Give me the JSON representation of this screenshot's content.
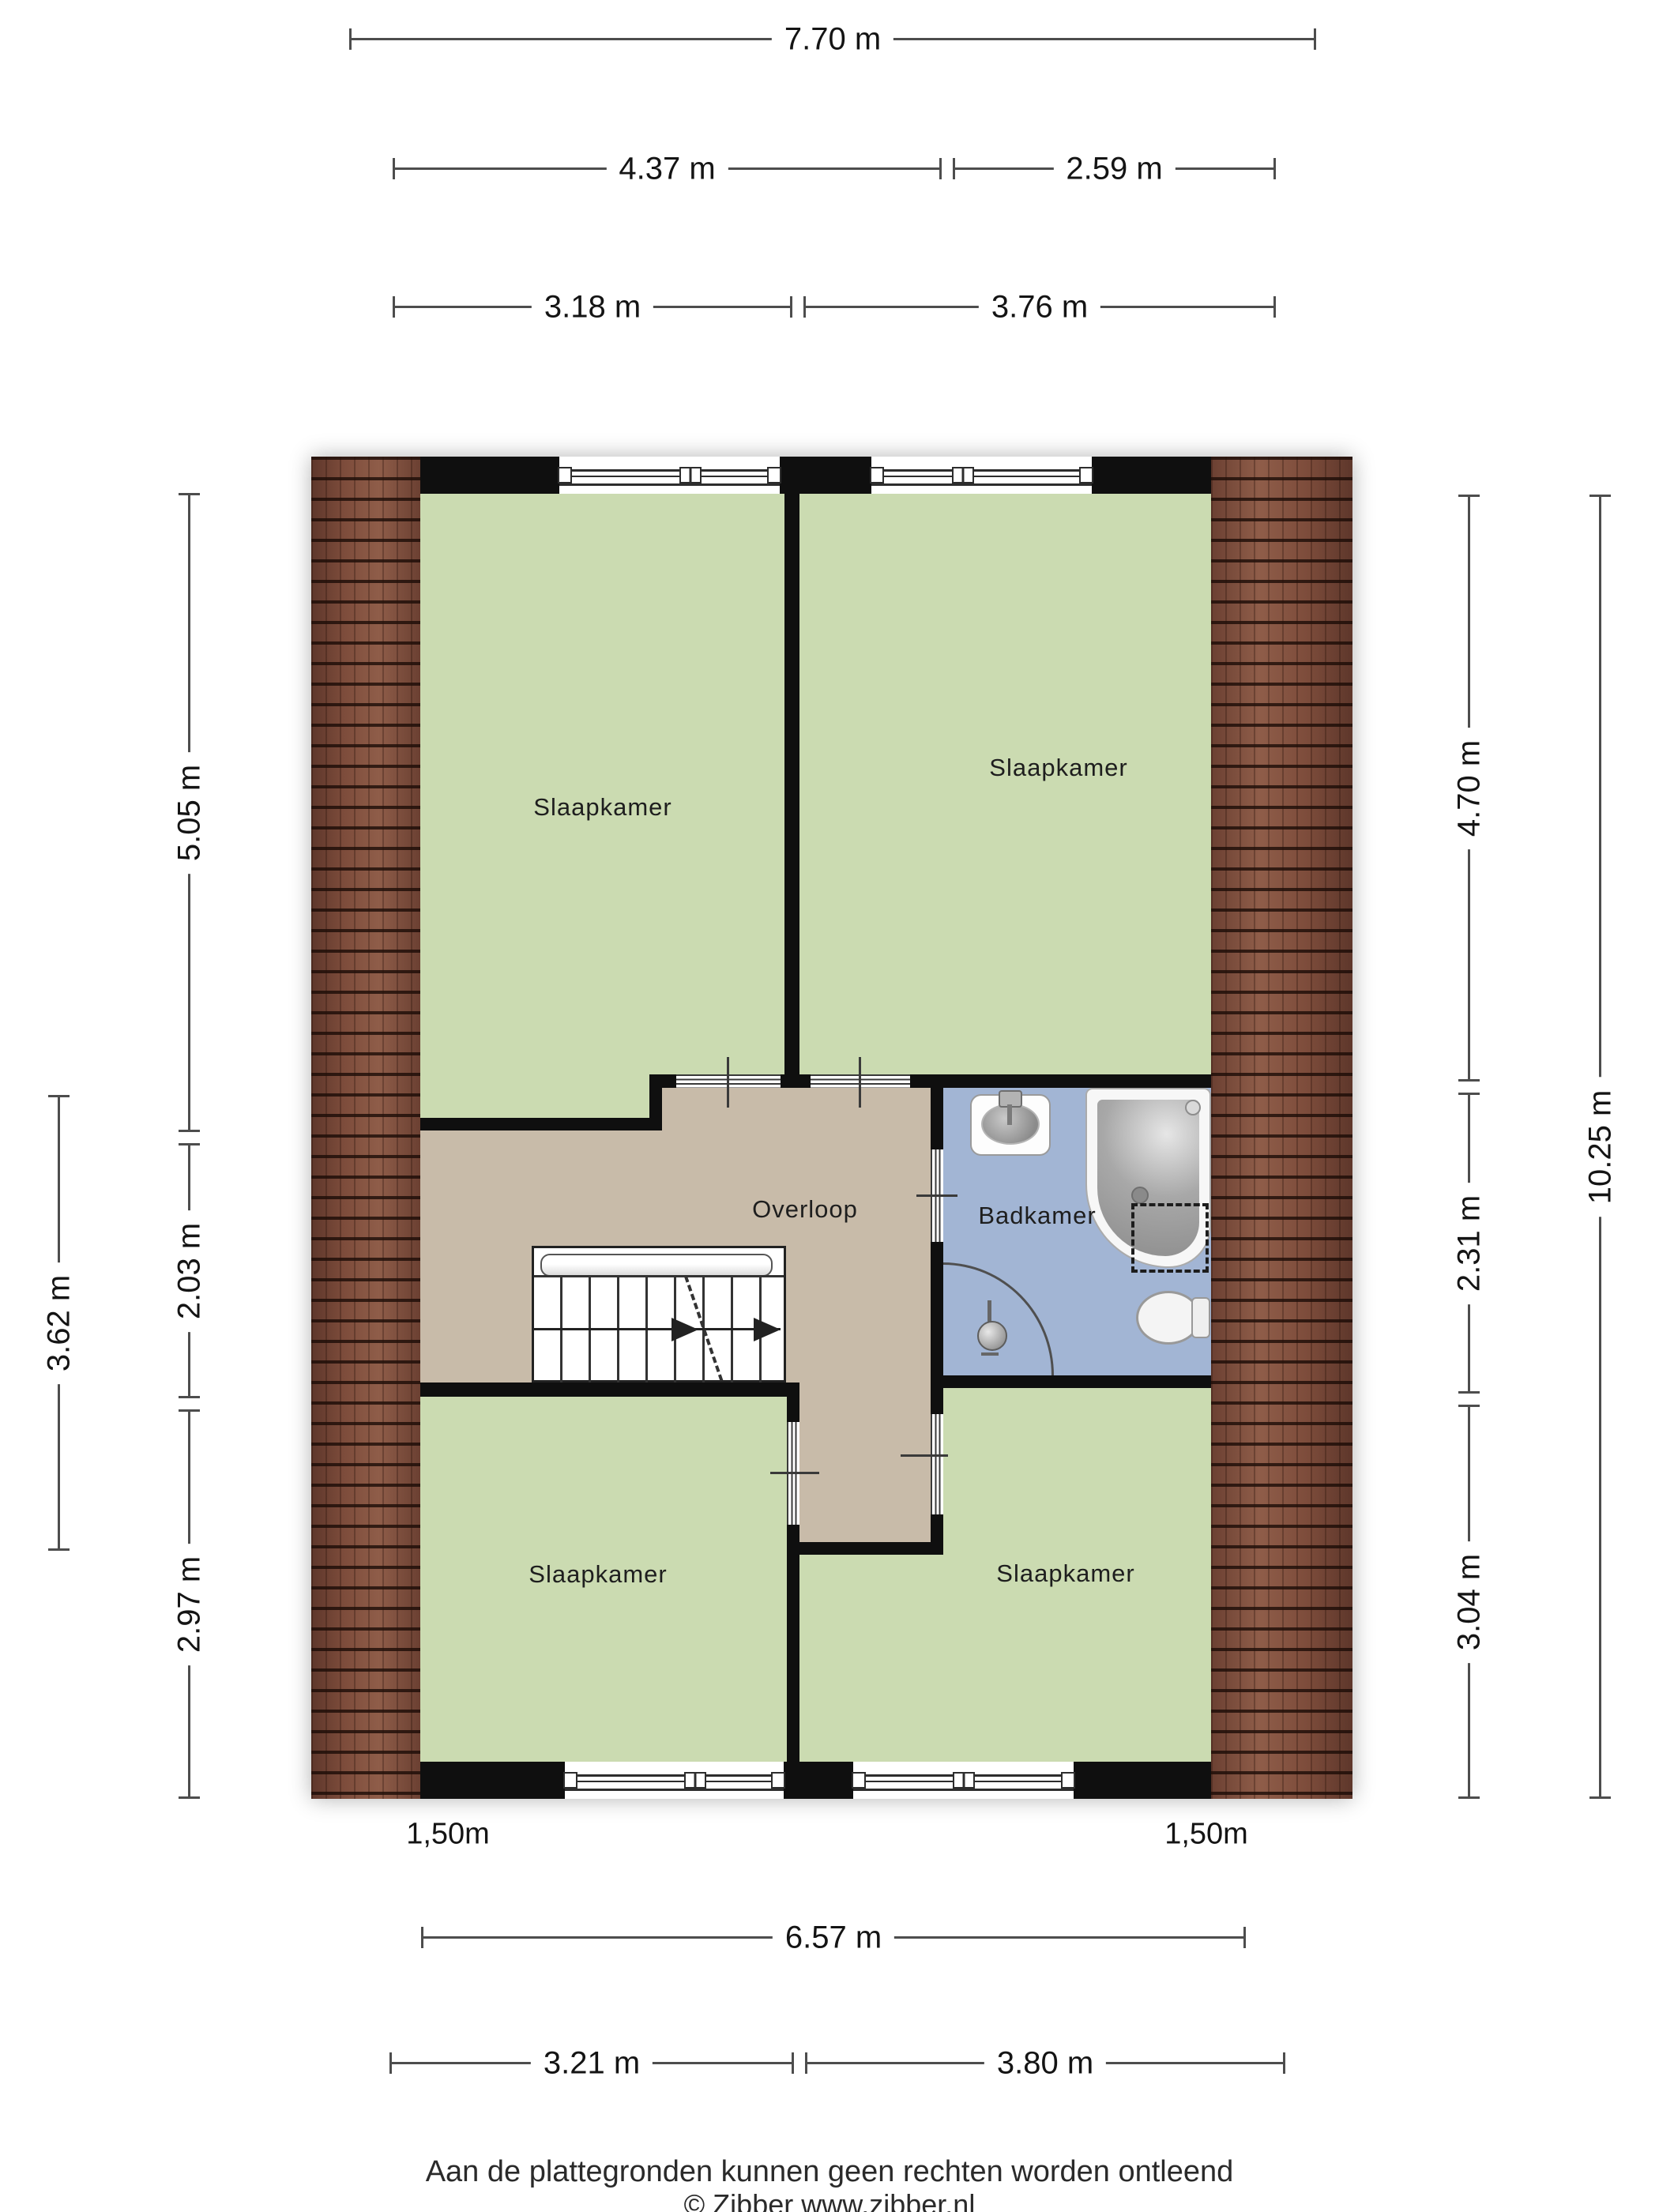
{
  "rooms": {
    "bedroom_tl": {
      "label": "Slaapkamer"
    },
    "bedroom_tr": {
      "label": "Slaapkamer"
    },
    "bedroom_bl": {
      "label": "Slaapkamer"
    },
    "bedroom_br": {
      "label": "Slaapkamer"
    },
    "landing": {
      "label": "Overloop"
    },
    "bathroom": {
      "label": "Badkamer"
    }
  },
  "dimensions": {
    "top_total": "7.70 m",
    "top_left": "4.37 m",
    "top_right": "2.59 m",
    "upper_left": "3.18 m",
    "upper_right": "3.76 m",
    "bottom_total": "6.57 m",
    "bottom_left": "3.21 m",
    "bottom_right": "3.80 m",
    "left_top": "5.05 m",
    "left_mid": "2.03 m",
    "left_bottom": "2.97 m",
    "left_outer": "3.62 m",
    "right_top": "4.70 m",
    "right_mid": "2.31 m",
    "right_bottom": "3.04 m",
    "right_outer": "10.25 m",
    "headroom_left": "1,50m",
    "headroom_right": "1,50m"
  },
  "footer": {
    "disclaimer": "Aan de plattegronden kunnen geen rechten worden ontleend",
    "credit": "© Zibber www.zibber.nl"
  },
  "colors": {
    "room_green": "#cbdbb1",
    "landing_tan": "#c8bba9",
    "bathroom_blue": "#a2b5d4",
    "wall": "#0f0f0f",
    "dim_line": "#4d4d4d"
  }
}
